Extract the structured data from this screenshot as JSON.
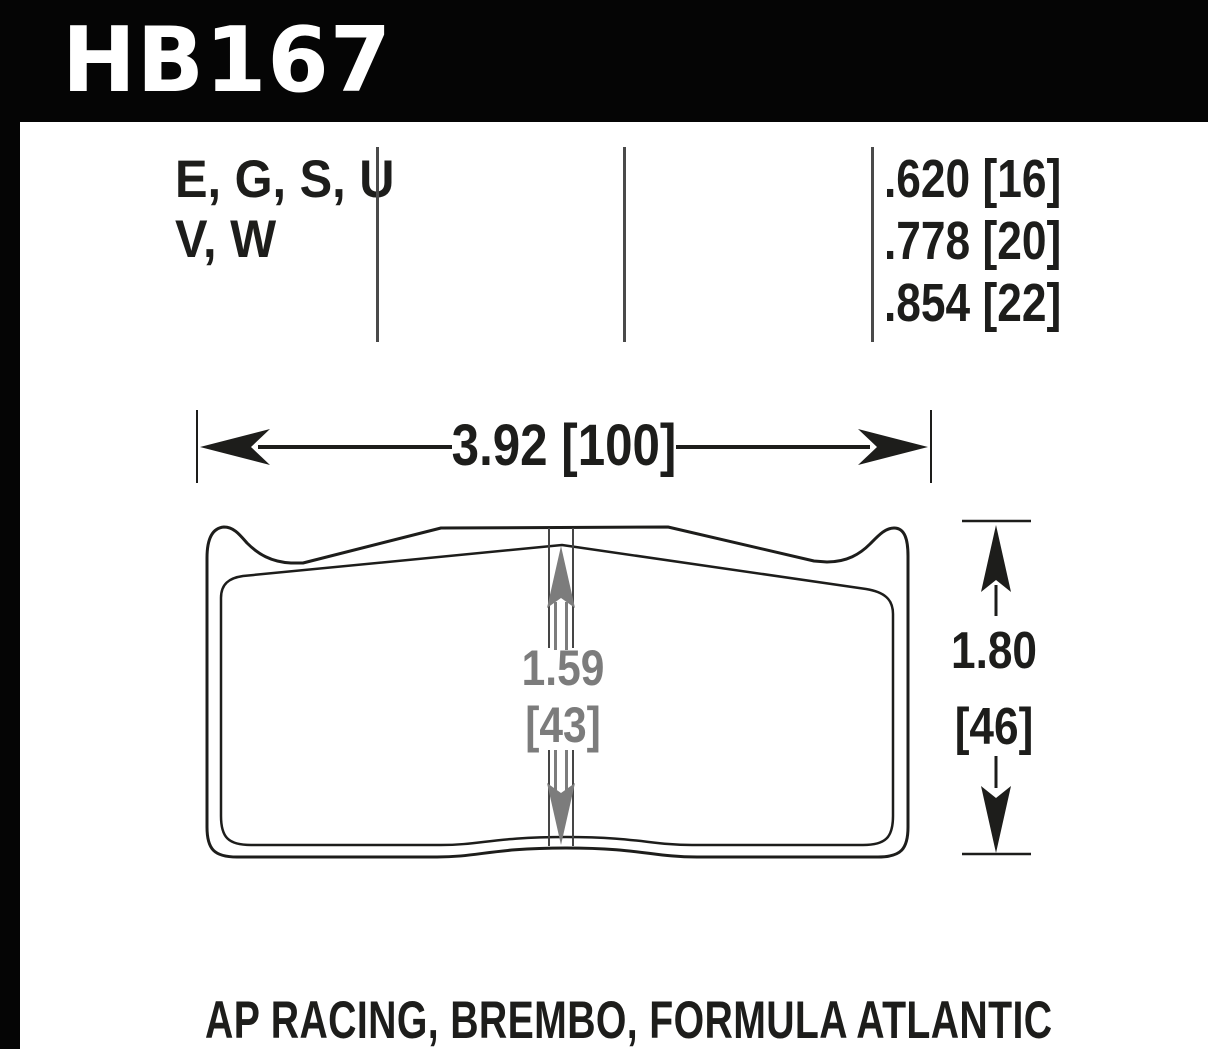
{
  "colors": {
    "banner_bg": "#050505",
    "ink": "#1d1d1b",
    "dimension_gray": "#7c7c7c",
    "background": "#ffffff"
  },
  "header": {
    "part_number": "HB167"
  },
  "spec_row": {
    "compound_codes_line1": "E, G, S, U",
    "compound_codes_line2": "V, W",
    "thicknesses": [
      ".620 [16]",
      ".778 [20]",
      ".854 [22]"
    ]
  },
  "diagram": {
    "width_dimension": "3.92 [100]",
    "pad_depth_dimension_value": "1.59",
    "pad_depth_dimension_mm": "[43]",
    "height_dimension_value": "1.80",
    "height_dimension_mm": "[46]"
  },
  "footer": {
    "applications": "AP RACING, BREMBO, FORMULA ATLANTIC"
  }
}
